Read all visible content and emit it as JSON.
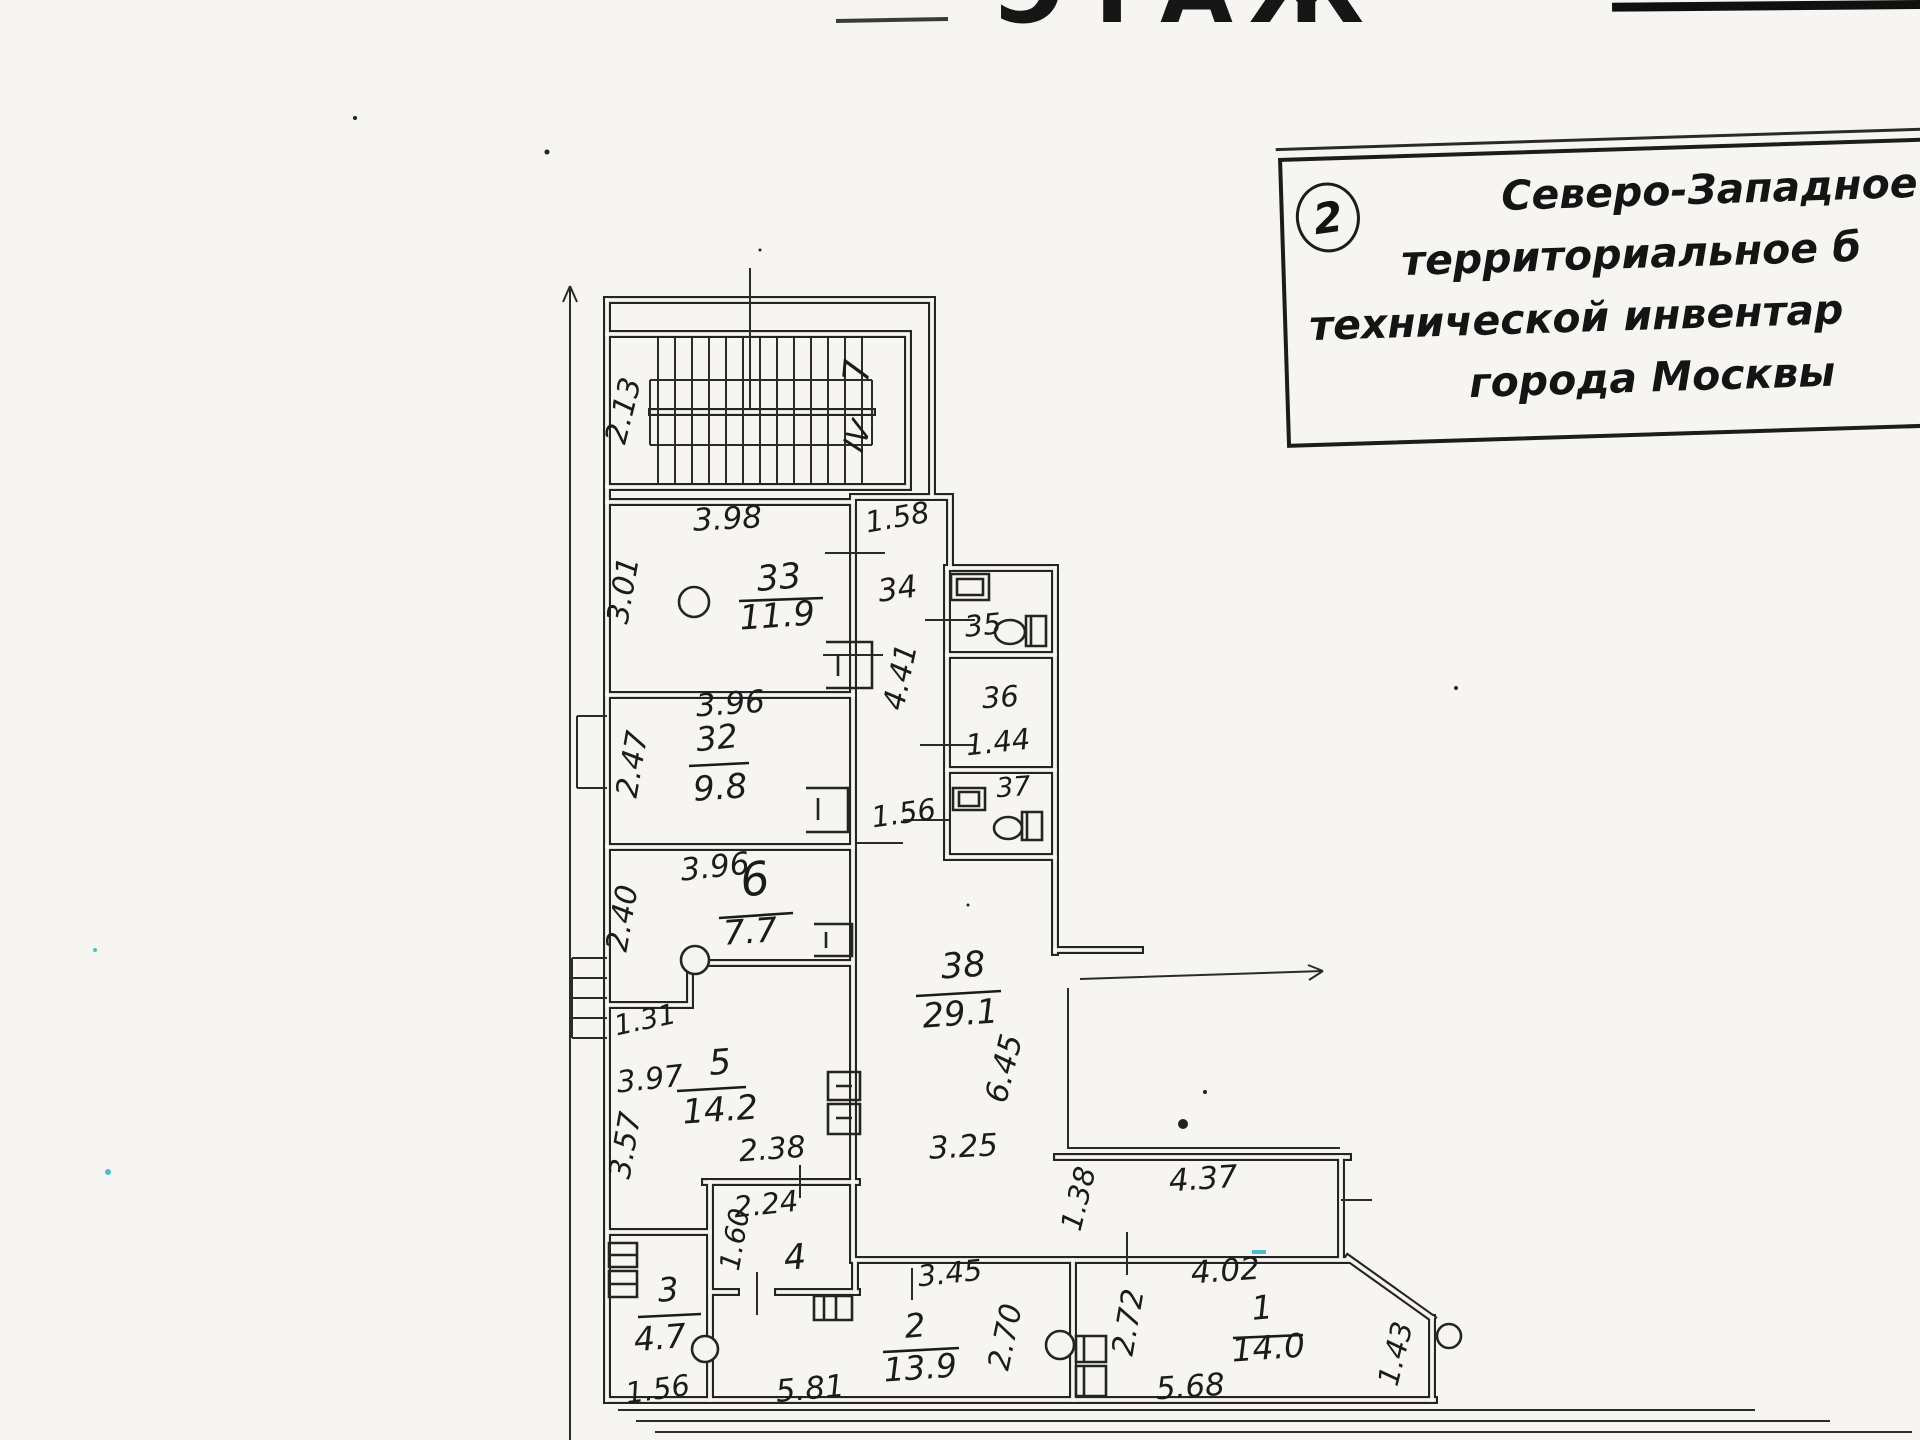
{
  "header": {
    "title_partial": "ЭТАЖ"
  },
  "stamp": {
    "number": "2",
    "lines": [
      "Северо-Западное",
      "территориальное б",
      "технической инвентар",
      "города Москвы"
    ]
  },
  "plan": {
    "labels": [
      {
        "name": "stair-width",
        "t": "2.13",
        "x": 633,
        "y": 413,
        "r": -76,
        "s": 30
      },
      {
        "name": "stair-number",
        "t": "7",
        "x": 869,
        "y": 372,
        "r": -85,
        "s": 36
      },
      {
        "name": "stair-section",
        "t": "IV",
        "x": 867,
        "y": 440,
        "r": -68,
        "s": 30
      },
      {
        "name": "vestibule-dim",
        "t": "1.58",
        "x": 899,
        "y": 527,
        "r": -10,
        "s": 29
      },
      {
        "name": "room33-top-dim",
        "t": "3.98",
        "x": 728,
        "y": 529,
        "r": -3,
        "s": 31
      },
      {
        "name": "room33-left-dim",
        "t": "3.01",
        "x": 633,
        "y": 592,
        "r": -80,
        "s": 30
      },
      {
        "name": "room33-number",
        "t": "33",
        "x": 780,
        "y": 589,
        "r": -5,
        "s": 35,
        "line": [
          739,
          601,
          823,
          598
        ]
      },
      {
        "name": "room33-area",
        "t": "11.9",
        "x": 778,
        "y": 627,
        "r": -4,
        "s": 34
      },
      {
        "name": "corridor34-number",
        "t": "34",
        "x": 899,
        "y": 599,
        "r": -8,
        "s": 31
      },
      {
        "name": "corridor34-length",
        "t": "4.41",
        "x": 910,
        "y": 679,
        "r": -78,
        "s": 30
      },
      {
        "name": "room35-number",
        "t": "35",
        "x": 984,
        "y": 635,
        "r": -6,
        "s": 29
      },
      {
        "name": "room36-number",
        "t": "36",
        "x": 1001,
        "y": 707,
        "r": -4,
        "s": 29
      },
      {
        "name": "room36-area",
        "t": "1.44",
        "x": 999,
        "y": 752,
        "r": -6,
        "s": 29
      },
      {
        "name": "room37-number",
        "t": "37",
        "x": 1014,
        "y": 796,
        "r": -4,
        "s": 27
      },
      {
        "name": "room32-top-dim",
        "t": "3.96",
        "x": 731,
        "y": 714,
        "r": -4,
        "s": 31
      },
      {
        "name": "room32-left-dim",
        "t": "2.47",
        "x": 642,
        "y": 766,
        "r": -80,
        "s": 30
      },
      {
        "name": "room32-number",
        "t": "32",
        "x": 718,
        "y": 749,
        "r": -6,
        "s": 33,
        "line": [
          689,
          766,
          749,
          763
        ]
      },
      {
        "name": "room32-area",
        "t": "9.8",
        "x": 721,
        "y": 799,
        "r": -4,
        "s": 34
      },
      {
        "name": "corridor-door-dim",
        "t": "1.56",
        "x": 905,
        "y": 823,
        "r": -8,
        "s": 29
      },
      {
        "name": "room6-top-dim",
        "t": "3.96",
        "x": 716,
        "y": 877,
        "r": -6,
        "s": 31
      },
      {
        "name": "room6-number",
        "t": "6",
        "x": 757,
        "y": 895,
        "r": -8,
        "s": 46,
        "line": [
          719,
          918,
          793,
          913
        ]
      },
      {
        "name": "room6-area",
        "t": "7.7",
        "x": 751,
        "y": 943,
        "r": -4,
        "s": 34
      },
      {
        "name": "room6-left-dim",
        "t": "2.40",
        "x": 632,
        "y": 920,
        "r": -80,
        "s": 30
      },
      {
        "name": "room5-step-dim",
        "t": "1.31",
        "x": 647,
        "y": 1029,
        "r": -12,
        "s": 28
      },
      {
        "name": "room5-upper-dim",
        "t": "3.97",
        "x": 651,
        "y": 1089,
        "r": -6,
        "s": 30
      },
      {
        "name": "room5-number",
        "t": "5",
        "x": 721,
        "y": 1074,
        "r": -5,
        "s": 35,
        "line": [
          677,
          1091,
          746,
          1087
        ]
      },
      {
        "name": "room5-area",
        "t": "14.2",
        "x": 721,
        "y": 1121,
        "r": -4,
        "s": 34
      },
      {
        "name": "room5-left-dim",
        "t": "3.57",
        "x": 635,
        "y": 1147,
        "r": -80,
        "s": 30
      },
      {
        "name": "room5-bottom-dim",
        "t": "2.38",
        "x": 773,
        "y": 1159,
        "r": -4,
        "s": 30
      },
      {
        "name": "room38-number",
        "t": "38",
        "x": 964,
        "y": 977,
        "r": -4,
        "s": 35,
        "line": [
          916,
          996,
          1001,
          991
        ]
      },
      {
        "name": "room38-area",
        "t": "29.1",
        "x": 961,
        "y": 1025,
        "r": -4,
        "s": 34
      },
      {
        "name": "room38-height-dim",
        "t": "6.45",
        "x": 1014,
        "y": 1071,
        "r": -76,
        "s": 31
      },
      {
        "name": "room38-bottom-dim",
        "t": "3.25",
        "x": 964,
        "y": 1157,
        "r": -3,
        "s": 31
      },
      {
        "name": "loggia-depth-dim",
        "t": "1.38",
        "x": 1088,
        "y": 1201,
        "r": -76,
        "s": 29
      },
      {
        "name": "loggia-length-dim",
        "t": "4.37",
        "x": 1204,
        "y": 1189,
        "r": -4,
        "s": 31
      },
      {
        "name": "room4-top-dim",
        "t": "2.24",
        "x": 767,
        "y": 1214,
        "r": -6,
        "s": 29
      },
      {
        "name": "room4-left-dim",
        "t": "1.60",
        "x": 744,
        "y": 1241,
        "r": -80,
        "s": 28
      },
      {
        "name": "room4-number",
        "t": "4",
        "x": 796,
        "y": 1269,
        "r": -5,
        "s": 35
      },
      {
        "name": "room3-number",
        "t": "3",
        "x": 669,
        "y": 1301,
        "r": -4,
        "s": 33,
        "line": [
          638,
          1317,
          701,
          1314
        ]
      },
      {
        "name": "room3-area",
        "t": "4.7",
        "x": 661,
        "y": 1349,
        "r": -5,
        "s": 33
      },
      {
        "name": "room3-bottom-dim",
        "t": "1.56",
        "x": 659,
        "y": 1399,
        "r": -8,
        "s": 29
      },
      {
        "name": "room2-bottom-dim",
        "t": "5.81",
        "x": 811,
        "y": 1399,
        "r": -5,
        "s": 31
      },
      {
        "name": "room2-top-dim",
        "t": "3.45",
        "x": 951,
        "y": 1283,
        "r": -6,
        "s": 29
      },
      {
        "name": "room2-number",
        "t": "2",
        "x": 916,
        "y": 1337,
        "r": -5,
        "s": 33,
        "line": [
          883,
          1352,
          959,
          1348
        ]
      },
      {
        "name": "room2-area",
        "t": "13.9",
        "x": 921,
        "y": 1379,
        "r": -4,
        "s": 33
      },
      {
        "name": "room2-right-dim",
        "t": "2.70",
        "x": 1015,
        "y": 1339,
        "r": -78,
        "s": 30
      },
      {
        "name": "room1-left-dim",
        "t": "2.72",
        "x": 1138,
        "y": 1324,
        "r": -80,
        "s": 30
      },
      {
        "name": "room1-top-dim",
        "t": "4.02",
        "x": 1226,
        "y": 1281,
        "r": -4,
        "s": 31
      },
      {
        "name": "room1-number",
        "t": "1",
        "x": 1263,
        "y": 1319,
        "r": -5,
        "s": 33,
        "line": [
          1233,
          1338,
          1303,
          1335
        ]
      },
      {
        "name": "room1-area",
        "t": "14.0",
        "x": 1269,
        "y": 1359,
        "r": -4,
        "s": 33
      },
      {
        "name": "room1-bottom-dim",
        "t": "5.68",
        "x": 1191,
        "y": 1397,
        "r": -4,
        "s": 31
      },
      {
        "name": "room1-right-dim",
        "t": "1.43",
        "x": 1405,
        "y": 1356,
        "r": -76,
        "s": 29
      }
    ]
  }
}
